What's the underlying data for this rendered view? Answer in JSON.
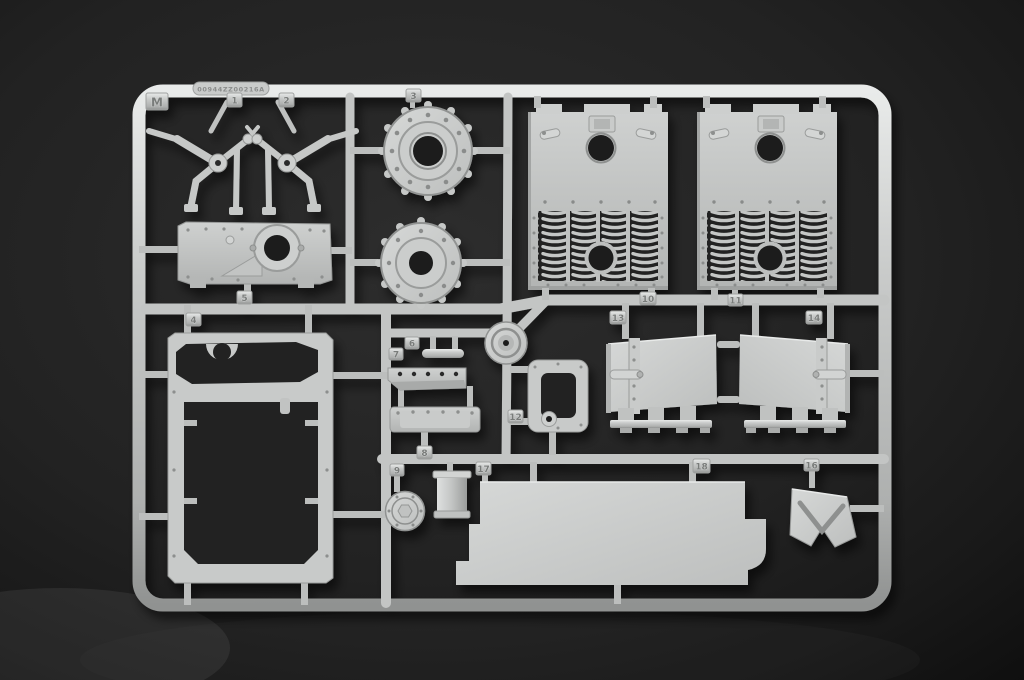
{
  "photo": {
    "subject": "Injection-molded light grey styrene model kit sprue (runner M) photographed on a dark fabric background",
    "sprue_letter": "M",
    "embossed_code": "00944ZZ00216A"
  },
  "tags": {
    "m": "M",
    "t1": "1",
    "t2": "2",
    "t3": "3",
    "t4": "4",
    "t5": "5",
    "t6": "6",
    "t7": "7",
    "t8": "8",
    "t9": "9",
    "t10": "10",
    "t11": "11",
    "t12": "12",
    "t13": "13",
    "t14": "14",
    "t16": "16",
    "t17": "17",
    "t18": "18"
  },
  "colors": {
    "background": "#1d1d1d",
    "plastic": "#c6c8c7",
    "plastic_highlight": "#e9ebea",
    "plastic_shadow": "#8f9190",
    "hole_dark": "#1b1c1c"
  },
  "parts": [
    {
      "number": "1",
      "appearance": "cluster of small suspension-arm linkages"
    },
    {
      "number": "2",
      "appearance": "mirrored cluster of small suspension-arm linkages"
    },
    {
      "number": "3",
      "appearance": "round bolted housing rings, two stacked on sprue"
    },
    {
      "number": "4",
      "appearance": "large open rectangular floor frame"
    },
    {
      "number": "5",
      "appearance": "riveted gearbox face plate with round boss"
    },
    {
      "number": "6",
      "appearance": "small rod"
    },
    {
      "number": "7",
      "appearance": "wedge strip with five holes"
    },
    {
      "number": "8",
      "appearance": "bolted mounting plate"
    },
    {
      "number": "9",
      "appearance": "round hub cap with hex center"
    },
    {
      "number": "10",
      "appearance": "engine deck grille plate with curved louvres"
    },
    {
      "number": "11",
      "appearance": "second engine deck grille plate"
    },
    {
      "number": "12",
      "appearance": "small rounded rectangular frame with boss"
    },
    {
      "number": "13",
      "appearance": "hinged hatch panel with bottom brackets"
    },
    {
      "number": "14",
      "appearance": "mirrored hinged hatch panel"
    },
    {
      "number": "16",
      "appearance": "angled V-notched bracket"
    },
    {
      "number": "17",
      "appearance": "small open box"
    },
    {
      "number": "18",
      "appearance": "large flat stepped hull panel"
    }
  ]
}
